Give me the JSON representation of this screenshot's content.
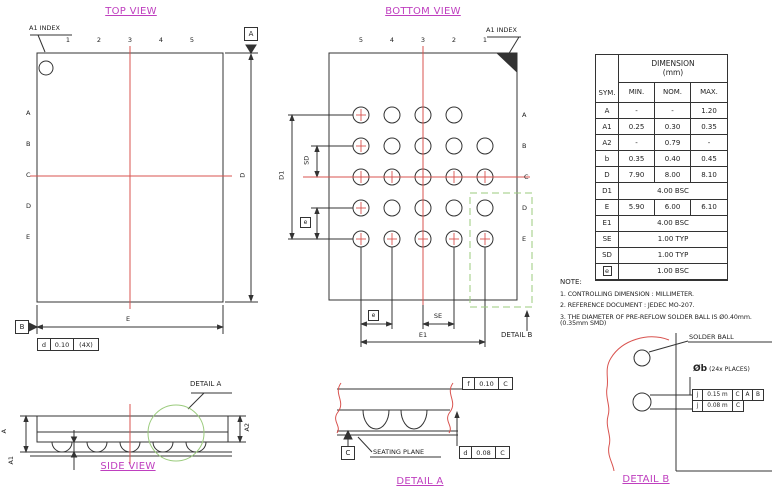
{
  "colors": {
    "accent_magenta": "#bf3fbf",
    "centerline_red": "#d9534f",
    "detail_green": "#9bcb7d",
    "line_black": "#333333"
  },
  "titles": {
    "top_view": "TOP VIEW",
    "bottom_view": "BOTTOM VIEW",
    "side_view": "SIDE VIEW",
    "detail_a": "DETAIL A",
    "detail_b": "DETAIL B"
  },
  "top_view": {
    "a1_index": "A1 INDEX",
    "col_labels": [
      "1",
      "2",
      "3",
      "4",
      "5"
    ],
    "row_labels": [
      "A",
      "B",
      "C",
      "D",
      "E"
    ],
    "datum_a": "A",
    "datum_b": "B",
    "dim_d": "D",
    "dim_e": "E",
    "fcf": {
      "sym": "d",
      "tol": "0.10",
      "note": "(4X)"
    }
  },
  "bottom_view": {
    "a1_index": "A1 INDEX",
    "col_labels": [
      "5",
      "4",
      "3",
      "2",
      "1"
    ],
    "row_labels": [
      "A",
      "B",
      "C",
      "D",
      "E"
    ],
    "dim_d1": "D1",
    "dim_sd": "SD",
    "pitch_sym": "e",
    "dim_se": "SE",
    "dim_e1": "E1",
    "detail_callout": "DETAIL B",
    "grid": {
      "rows": 5,
      "cols": 5,
      "missing": [
        [
          0,
          4
        ]
      ],
      "cross_rows": [
        2,
        4
      ],
      "cross_cols": [
        0
      ]
    }
  },
  "side_view": {
    "detail_callout": "DETAIL A",
    "dim_a": "A",
    "dim_a1": "A1",
    "dim_a2": "A2"
  },
  "detail_a": {
    "seating_plane": "SEATING PLANE",
    "datum_c": "C",
    "fcf_top": {
      "sym": "f",
      "tol": "0.10",
      "datum": "C"
    },
    "fcf_bottom": {
      "sym": "d",
      "tol": "0.08",
      "datum": "C"
    }
  },
  "detail_b": {
    "solder_ball": "SOLDER BALL",
    "dia_sym": "Øb",
    "places": "(24x PLACES)",
    "fcf1": {
      "sym": "j",
      "tol": "0.15 m",
      "d1": "C",
      "d2": "A",
      "d3": "B"
    },
    "fcf2": {
      "sym": "j",
      "tol": "0.08 m",
      "d1": "C"
    }
  },
  "table": {
    "sym_header": "SYM.",
    "dim_header": "DIMENSION",
    "dim_unit": "(mm)",
    "min_header": "MIN.",
    "nom_header": "NOM.",
    "max_header": "MAX.",
    "rows": [
      {
        "sym": "A",
        "min": "-",
        "nom": "-",
        "max": "1.20"
      },
      {
        "sym": "A1",
        "min": "0.25",
        "nom": "0.30",
        "max": "0.35"
      },
      {
        "sym": "A2",
        "min": "-",
        "nom": "0.79",
        "max": "-"
      },
      {
        "sym": "b",
        "min": "0.35",
        "nom": "0.40",
        "max": "0.45"
      },
      {
        "sym": "D",
        "min": "7.90",
        "nom": "8.00",
        "max": "8.10"
      },
      {
        "sym": "D1",
        "span": "4.00 BSC"
      },
      {
        "sym": "E",
        "min": "5.90",
        "nom": "6.00",
        "max": "6.10"
      },
      {
        "sym": "E1",
        "span": "4.00 BSC"
      },
      {
        "sym": "SE",
        "span": "1.00 TYP"
      },
      {
        "sym": "SD",
        "span": "1.00 TYP"
      },
      {
        "sym": "e",
        "boxed": true,
        "span": "1.00 BSC"
      }
    ]
  },
  "notes": {
    "title": "NOTE:",
    "items": [
      "1. CONTROLLING DIMENSION : MILLIMETER.",
      "2. REFERENCE DOCUMENT : JEDEC MO-207.",
      "3. THE DIAMETER OF PRE-REFLOW SOLDER BALL IS Ø0.40mm.(0.35mm SMD)"
    ]
  }
}
